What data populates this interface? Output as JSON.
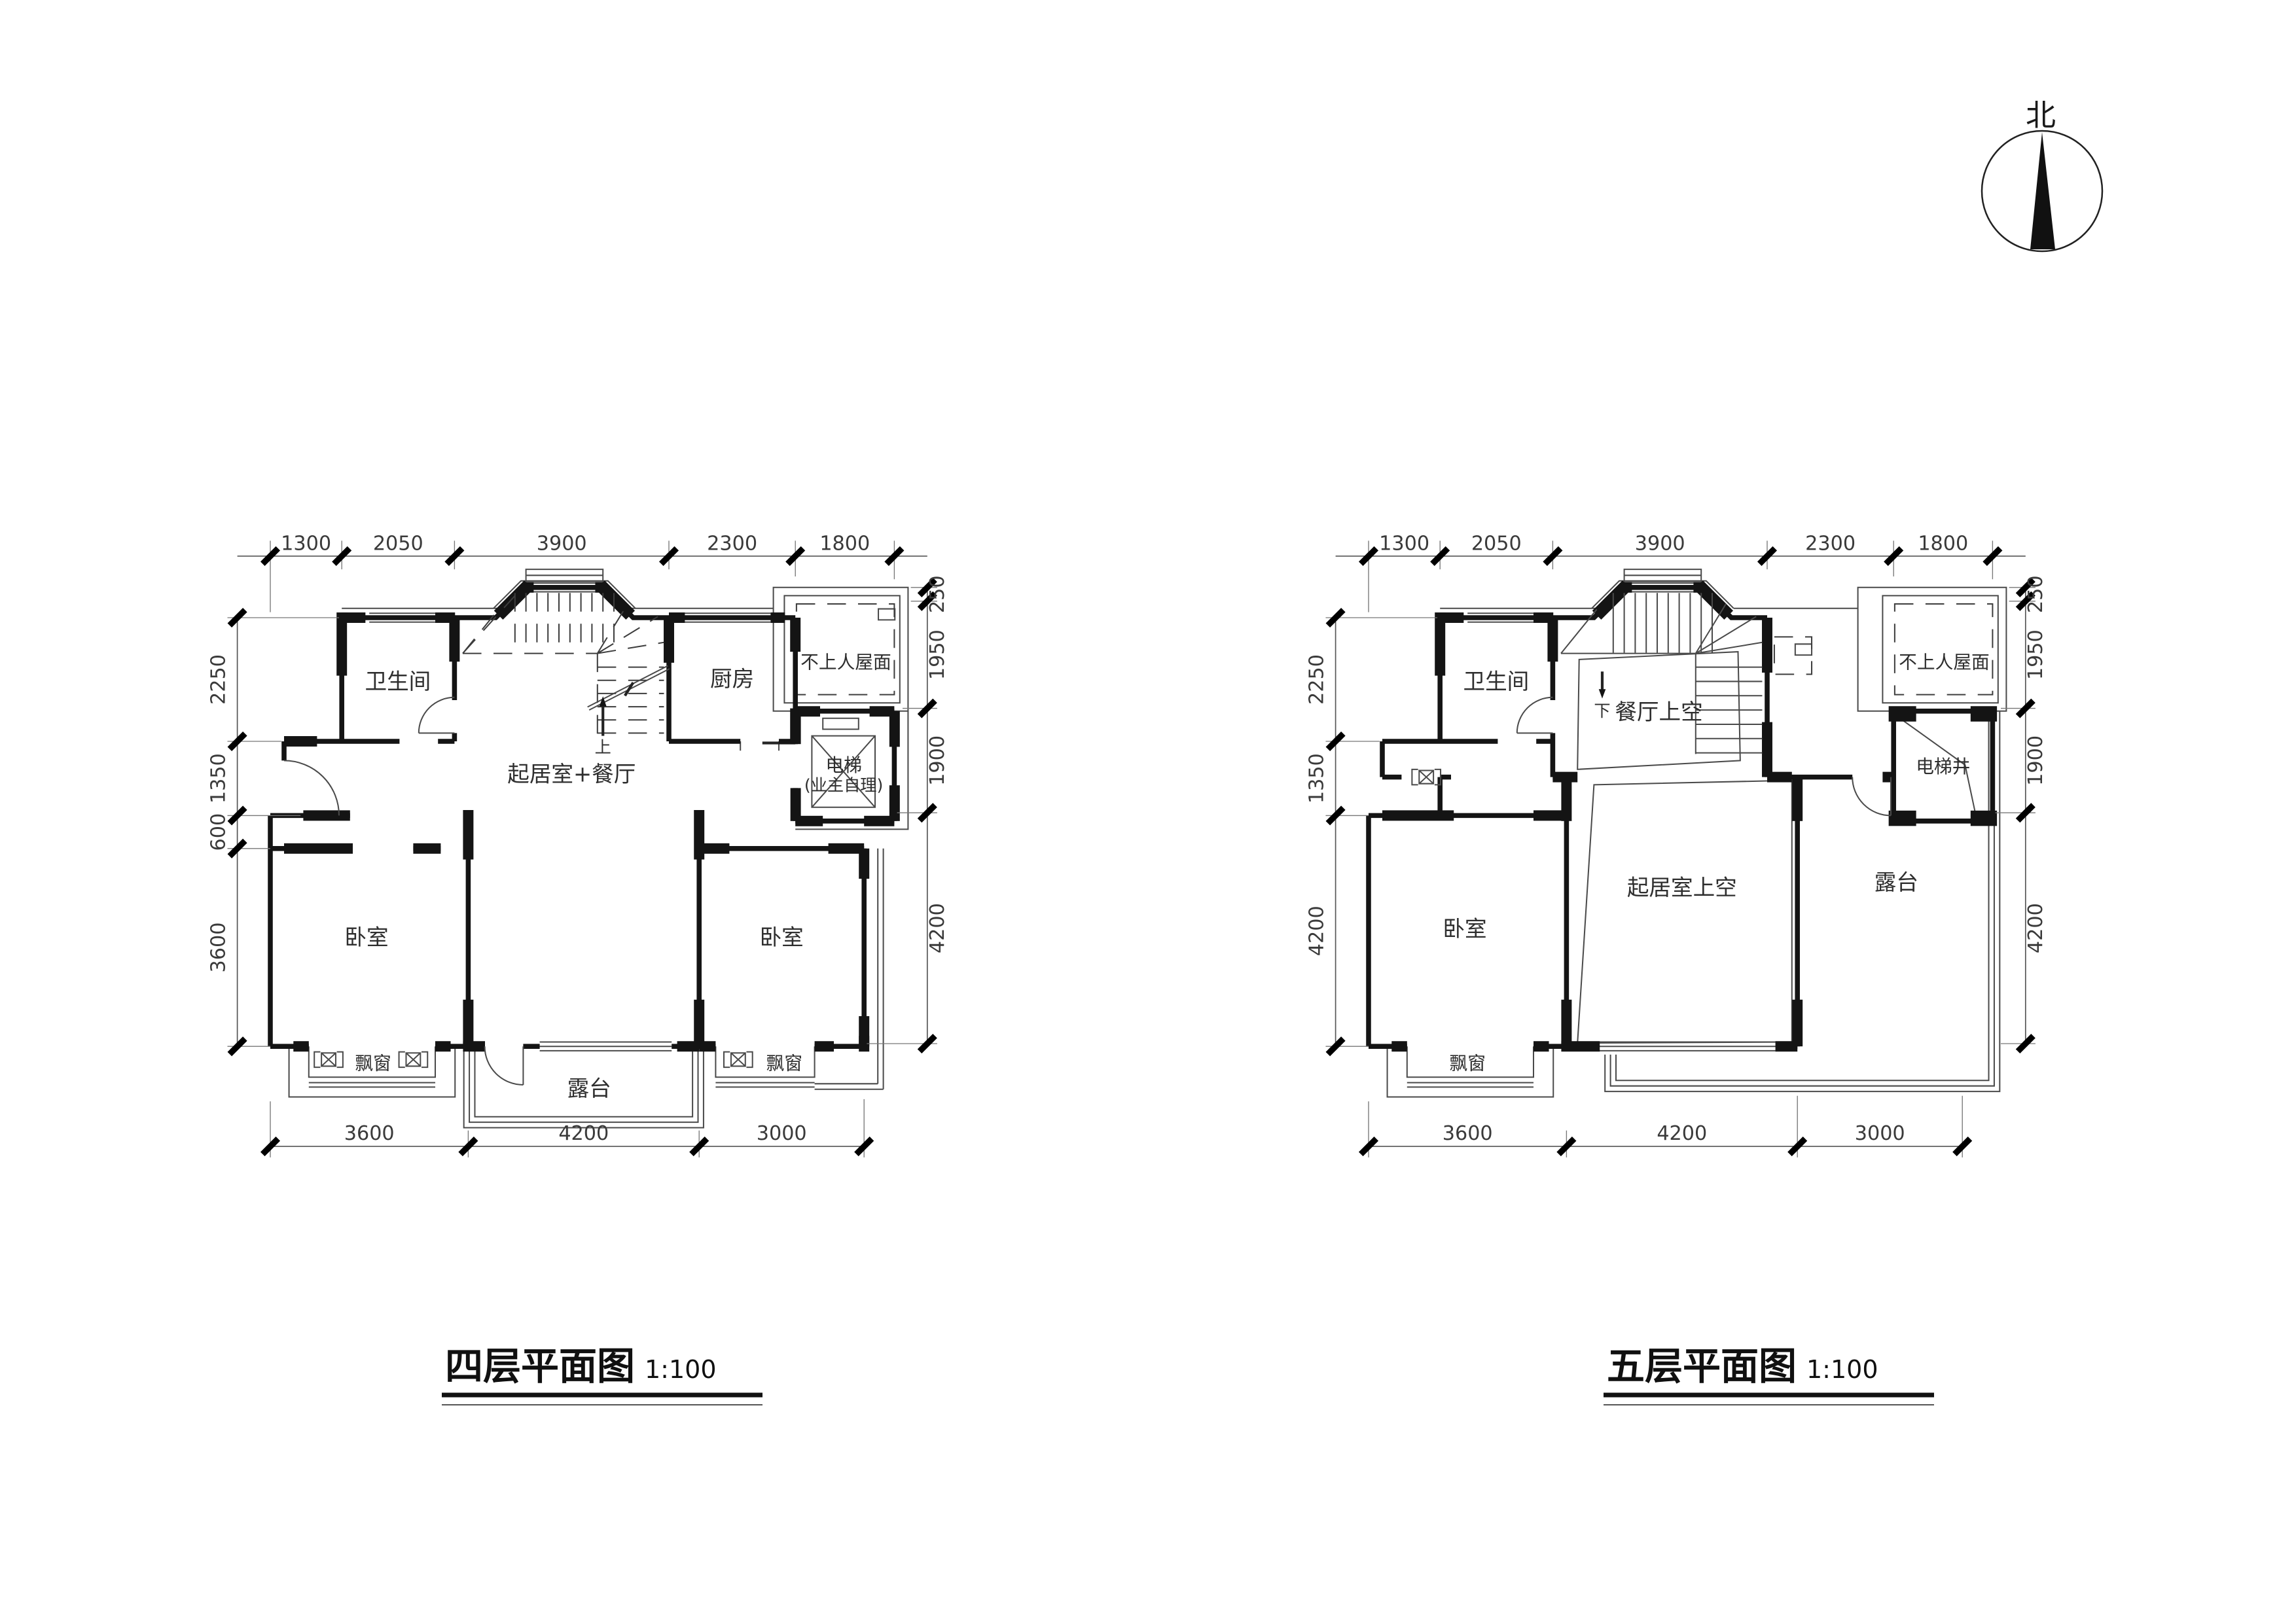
{
  "sheet": {
    "background": "#ffffff",
    "line_color": "#141414"
  },
  "north_indicator": {
    "label": "北"
  },
  "plans": [
    {
      "id": "fourth-floor",
      "title": "四层平面图",
      "scale_label": "1:100",
      "dimensions": {
        "top": [
          "1300",
          "2050",
          "3900",
          "2300",
          "1800"
        ],
        "left": [
          "2250",
          "1350",
          "600",
          "3600"
        ],
        "right": [
          "250",
          "1950",
          "1900",
          "4200"
        ],
        "bottom": [
          "3600",
          "4200",
          "3000"
        ]
      },
      "rooms": {
        "bathroom": "卫生间",
        "kitchen": "厨房",
        "roof": "不上人屋面",
        "elevator": "电梯",
        "elevator_note": "(业主自理)",
        "living_dining": "起居室+餐厅",
        "bedroom_left": "卧室",
        "bedroom_right": "卧室",
        "bay_window_left": "飘窗",
        "bay_window_right": "飘窗",
        "terrace": "露台",
        "stair_direction": "上"
      }
    },
    {
      "id": "fifth-floor",
      "title": "五层平面图",
      "scale_label": "1:100",
      "dimensions": {
        "top": [
          "1300",
          "2050",
          "3900",
          "2300",
          "1800"
        ],
        "left": [
          "2250",
          "1350",
          "4200"
        ],
        "right": [
          "250",
          "1950",
          "1900",
          "4200"
        ],
        "bottom": [
          "3600",
          "4200",
          "3000"
        ]
      },
      "rooms": {
        "bathroom": "卫生间",
        "dining_void": "餐厅上空",
        "roof": "不上人屋面",
        "elevator_shaft": "电梯井",
        "living_void": "起居室上空",
        "bedroom": "卧室",
        "bay_window": "飘窗",
        "terrace": "露台",
        "stair_direction": "下"
      }
    }
  ]
}
